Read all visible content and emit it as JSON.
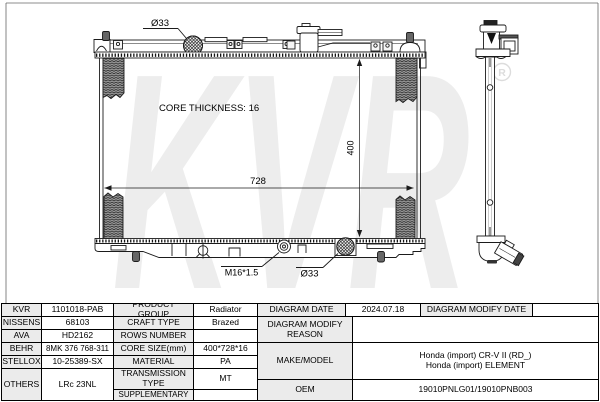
{
  "diagram": {
    "labels": {
      "inlet_diameter": "Ø33",
      "core_thickness": "CORE THICKNESS: 16",
      "core_width": "728",
      "core_height": "400",
      "drain_plug_thread": "M16*1.5",
      "outlet_diameter": "Ø33"
    },
    "watermark": {
      "text": "KVR",
      "mark": "R"
    }
  },
  "table": {
    "brands": [
      {
        "name": "KVR",
        "number": "1101018-PAB"
      },
      {
        "name": "NISSENS",
        "number": "68103"
      },
      {
        "name": "AVA",
        "number": "HD2162"
      },
      {
        "name": "BEHR",
        "number": "8MK 376 768-311"
      },
      {
        "name": "STELLOX",
        "number": "10-25389-SX"
      },
      {
        "name": "OTHERS",
        "number": "LRc 23NL"
      }
    ],
    "specs": [
      {
        "label": "PRODUCT GROUP",
        "value": "Radiator"
      },
      {
        "label": "CRAFT TYPE",
        "value": "Brazed"
      },
      {
        "label": "ROWS NUMBER",
        "value": ""
      },
      {
        "label": "CORE SIZE(mm)",
        "value": "400*728*16"
      },
      {
        "label": "MATERIAL",
        "value": "PA"
      },
      {
        "label": "TRANSMISSION TYPE",
        "value": "MT"
      },
      {
        "label": "SUPPLEMENTARY",
        "value": ""
      }
    ],
    "right": {
      "diagram_date_label": "DIAGRAM DATE",
      "diagram_date": "2024.07.18",
      "diagram_modify_date_label": "DIAGRAM MODIFY DATE",
      "diagram_modify_date": "",
      "diagram_modify_reason_label": "DIAGRAM MODIFY REASON",
      "diagram_modify_reason": "",
      "make_model_label": "MAKE/MODEL",
      "make_model_line1": "Honda (import) CR-V II (RD_)",
      "make_model_line2": "Honda (import) ELEMENT",
      "oem_label": "OEM",
      "oem": "19010PNLG01/19010PNB003"
    }
  },
  "colors": {
    "line": "#1b1b1b",
    "label_cell_bg": "#ebebeb",
    "watermark": "#ededed"
  }
}
